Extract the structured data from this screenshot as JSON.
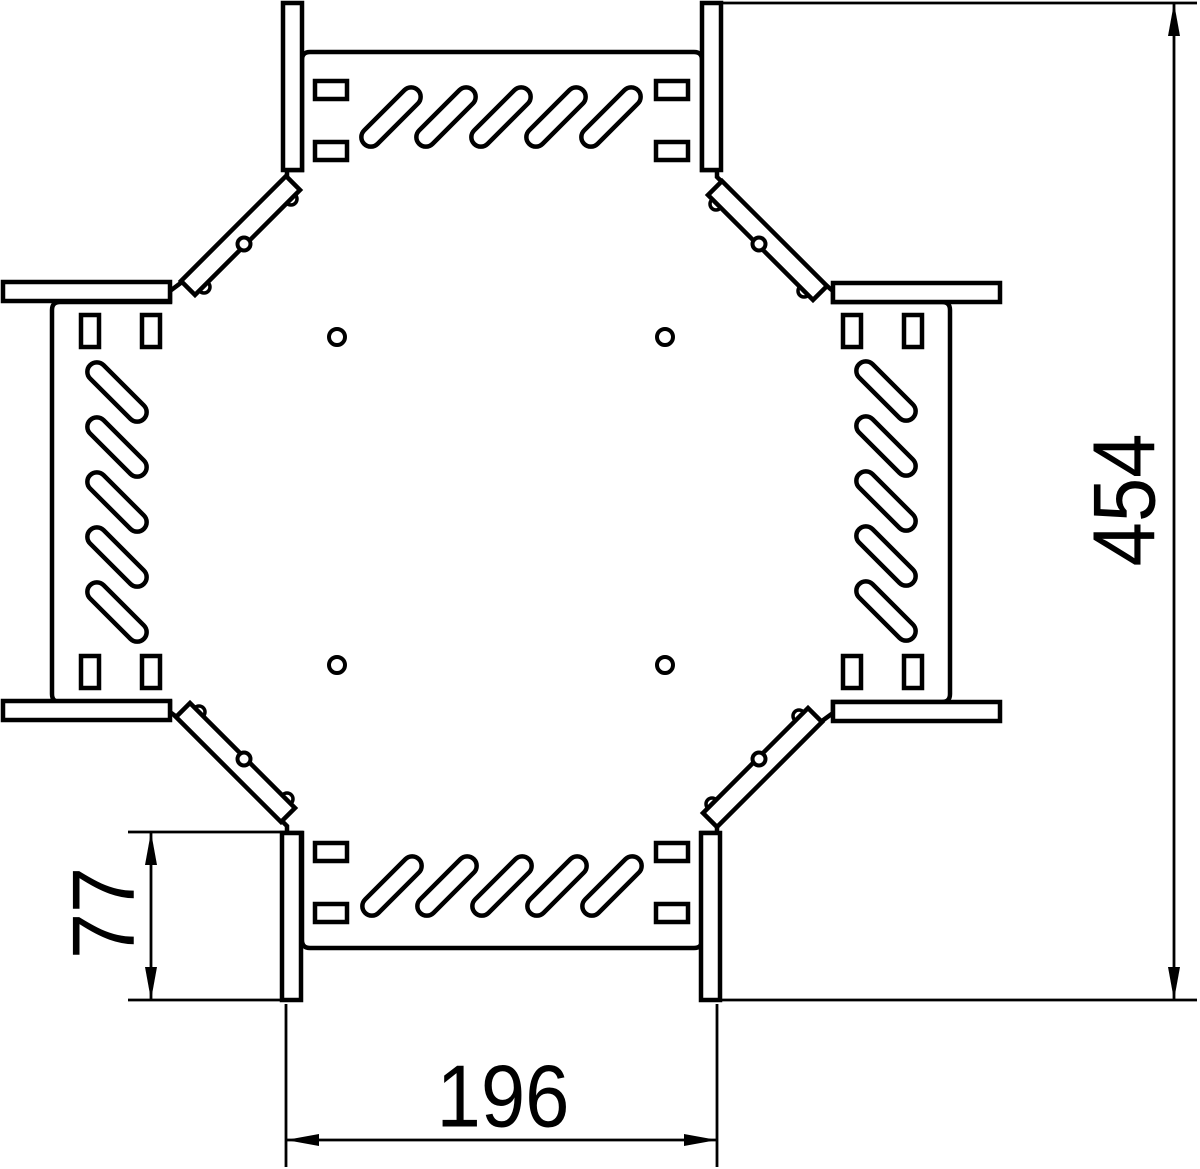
{
  "drawing": {
    "title": "Cable tray cross piece - top view technical drawing",
    "background_color": "#ffffff",
    "line_color": "#000000",
    "canvas": {
      "width": 1200,
      "height": 1169
    }
  },
  "dimensions": {
    "overall_length": {
      "label": "454",
      "orientation": "vertical",
      "position": "right"
    },
    "duct_width": {
      "label": "196",
      "orientation": "horizontal",
      "position": "bottom"
    },
    "flange_length": {
      "label": "77",
      "orientation": "vertical",
      "position": "bottom-left"
    }
  },
  "features": {
    "arms": 4,
    "oblong_slots_per_arm": 5,
    "rect_slots_per_arm": 4,
    "corner_gussets": 4,
    "gusset_holes": 4,
    "center_holes": 4
  }
}
